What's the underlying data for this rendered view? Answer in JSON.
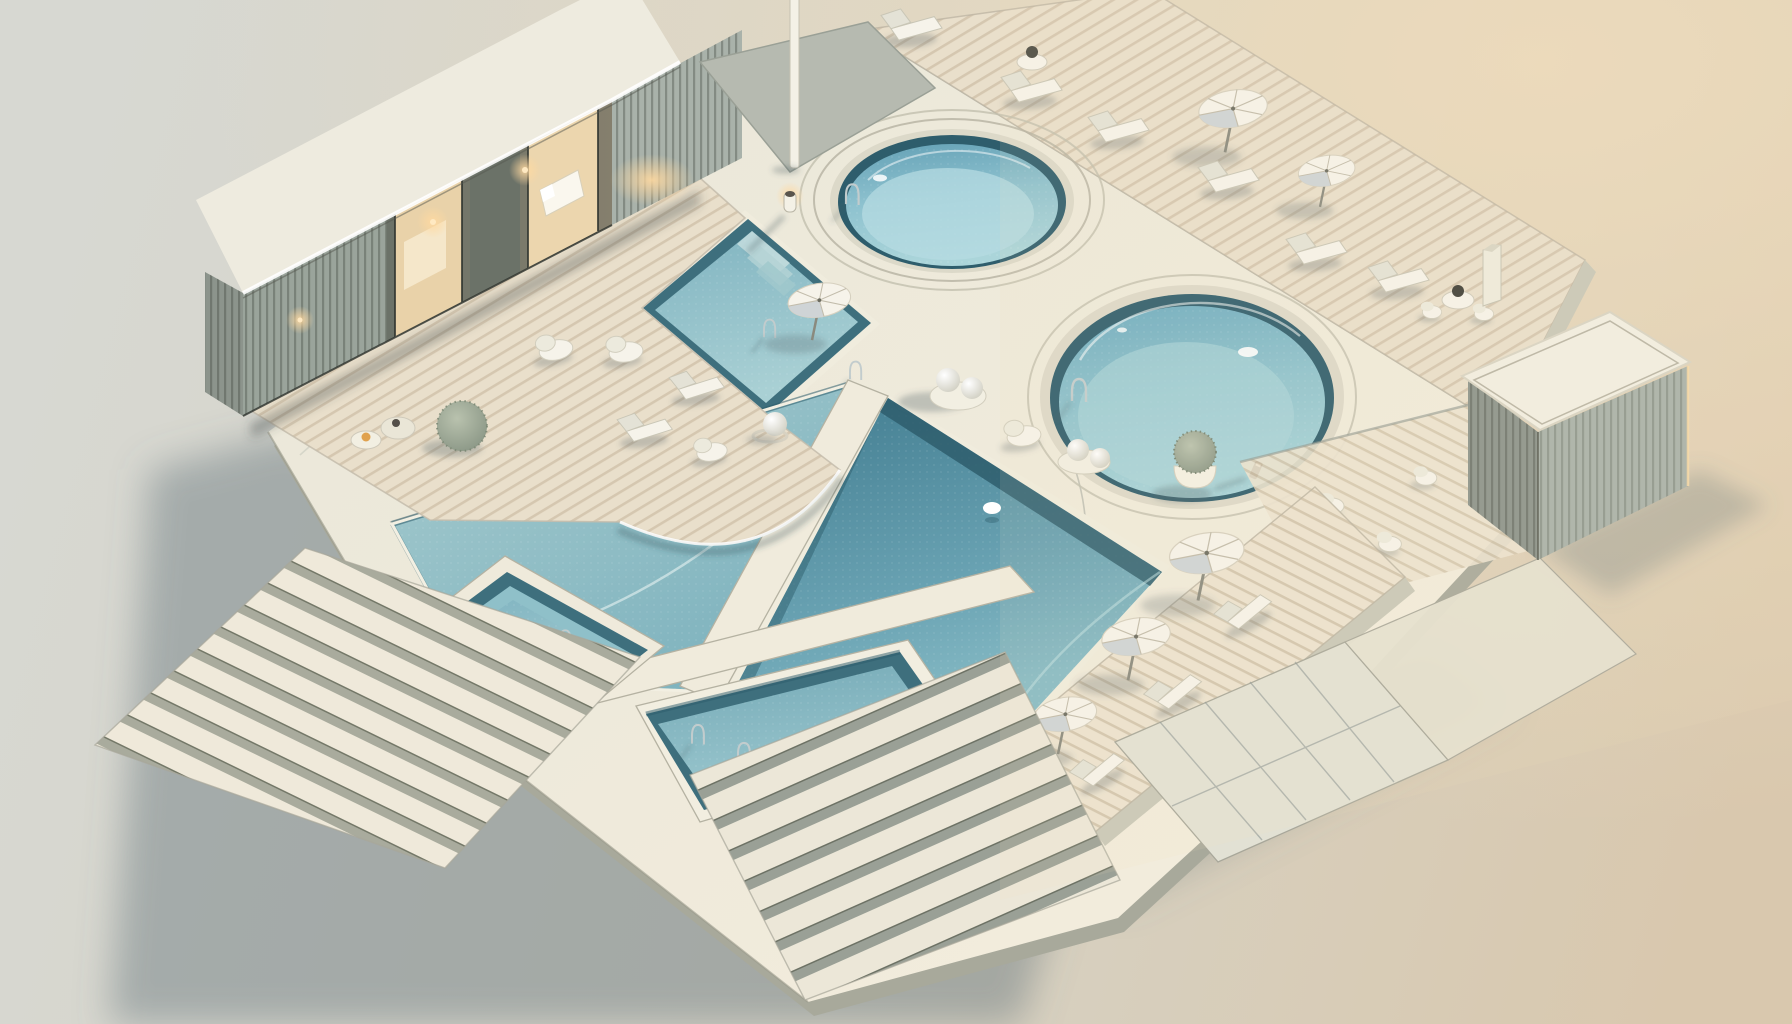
{
  "meta": {
    "title": "Minimalist isometric 3D render of a luxury pool complex at dusk",
    "style": "architectural visualization, soft warm side light from upper right"
  },
  "palette": {
    "bg_left": "#d8d9d3",
    "bg_right": "#d9c9b1",
    "bg_warm_glow": "#ead8bd",
    "ground_shadow": "rgba(96,113,118,0.42)",
    "platform_light": "#f3eedf",
    "platform": "#ebe8d9",
    "platform_cool": "#e2e1d4",
    "side_face": "#c9c8b8",
    "side_dark": "#a8a99b",
    "walkway": "#f0ebdc",
    "wood_light": "#e9dfcb",
    "wood_stripe": "#c8b79e",
    "rim_dark": "#2e5d6c",
    "rim_teal": "#3e6f7d",
    "water_pale": "#aed4da",
    "water_light": "#96c5cf",
    "water_mid": "#7fb5c1",
    "water_deep": "#4a8397",
    "white_furniture": "#f6f3ea",
    "furniture_shade": "#cfd4d4",
    "metal": "#c2cccd",
    "slat": "#a9b2aa",
    "slat_dark": "#8c948c",
    "glass_dark": "#5f665e",
    "glow_warm": "#f5d9a8",
    "lamp_glow": "#ffd9a0",
    "plant": "#9aa794",
    "stone_accent": "#e0a24f",
    "seam": "#8e968f"
  },
  "scene": {
    "objects": [
      {
        "id": "pavilion",
        "label": "flat-roof pavilion with glowing glass facade and slatted walls"
      },
      {
        "id": "flag-pole",
        "label": "tall white flag pole"
      },
      {
        "id": "top-round-pool",
        "label": "small circular pool with concentric white rings"
      },
      {
        "id": "large-round-pool",
        "label": "large circular pool with dark tiled rim"
      },
      {
        "id": "upper-left-pool",
        "label": "square wading pool with submerged steps, umbrella and ladders"
      },
      {
        "id": "middle-pool",
        "label": "large central pool under curved deck overhang"
      },
      {
        "id": "deep-pool",
        "label": "deep center-right pool with dark water"
      },
      {
        "id": "lower-left-pool",
        "label": "small sunken pool with stepped rim"
      },
      {
        "id": "bottom-lap-pool",
        "label": "bottom lap pool with two ladders"
      },
      {
        "id": "walkway-cross",
        "label": "white walkway strips between pools"
      },
      {
        "id": "wood-deck",
        "label": "curved timber deck with pebble loungers, stones and shrub ball"
      },
      {
        "id": "top-deck-band",
        "label": "diagonal timber deck with sun loungers, umbrellas and side tables"
      },
      {
        "id": "umbrella-deck-band",
        "label": "striped deck band with three umbrellas and loungers"
      },
      {
        "id": "chair-terrace",
        "label": "lower plank terrace with white sculptural chairs"
      },
      {
        "id": "panel-terrace",
        "label": "panelled terrace with grid seams"
      },
      {
        "id": "cube-building",
        "label": "white slatted cube pool house"
      },
      {
        "id": "chimney",
        "label": "white chimney pillar"
      },
      {
        "id": "table-set",
        "label": "round table with kettle and two chairs"
      },
      {
        "id": "grand-staircase",
        "label": "wide staircase descending to lower left"
      },
      {
        "id": "bottom-steps",
        "label": "broad steps descending to lower right"
      },
      {
        "id": "sphere-decor",
        "label": "white sphere and pebble seat clusters"
      },
      {
        "id": "plant-pot",
        "label": "potted spiky shrub"
      },
      {
        "id": "bollard-lamp",
        "label": "small bollard lamp"
      },
      {
        "id": "ground",
        "label": "neutral studio ground, cool left, warm right"
      }
    ]
  }
}
